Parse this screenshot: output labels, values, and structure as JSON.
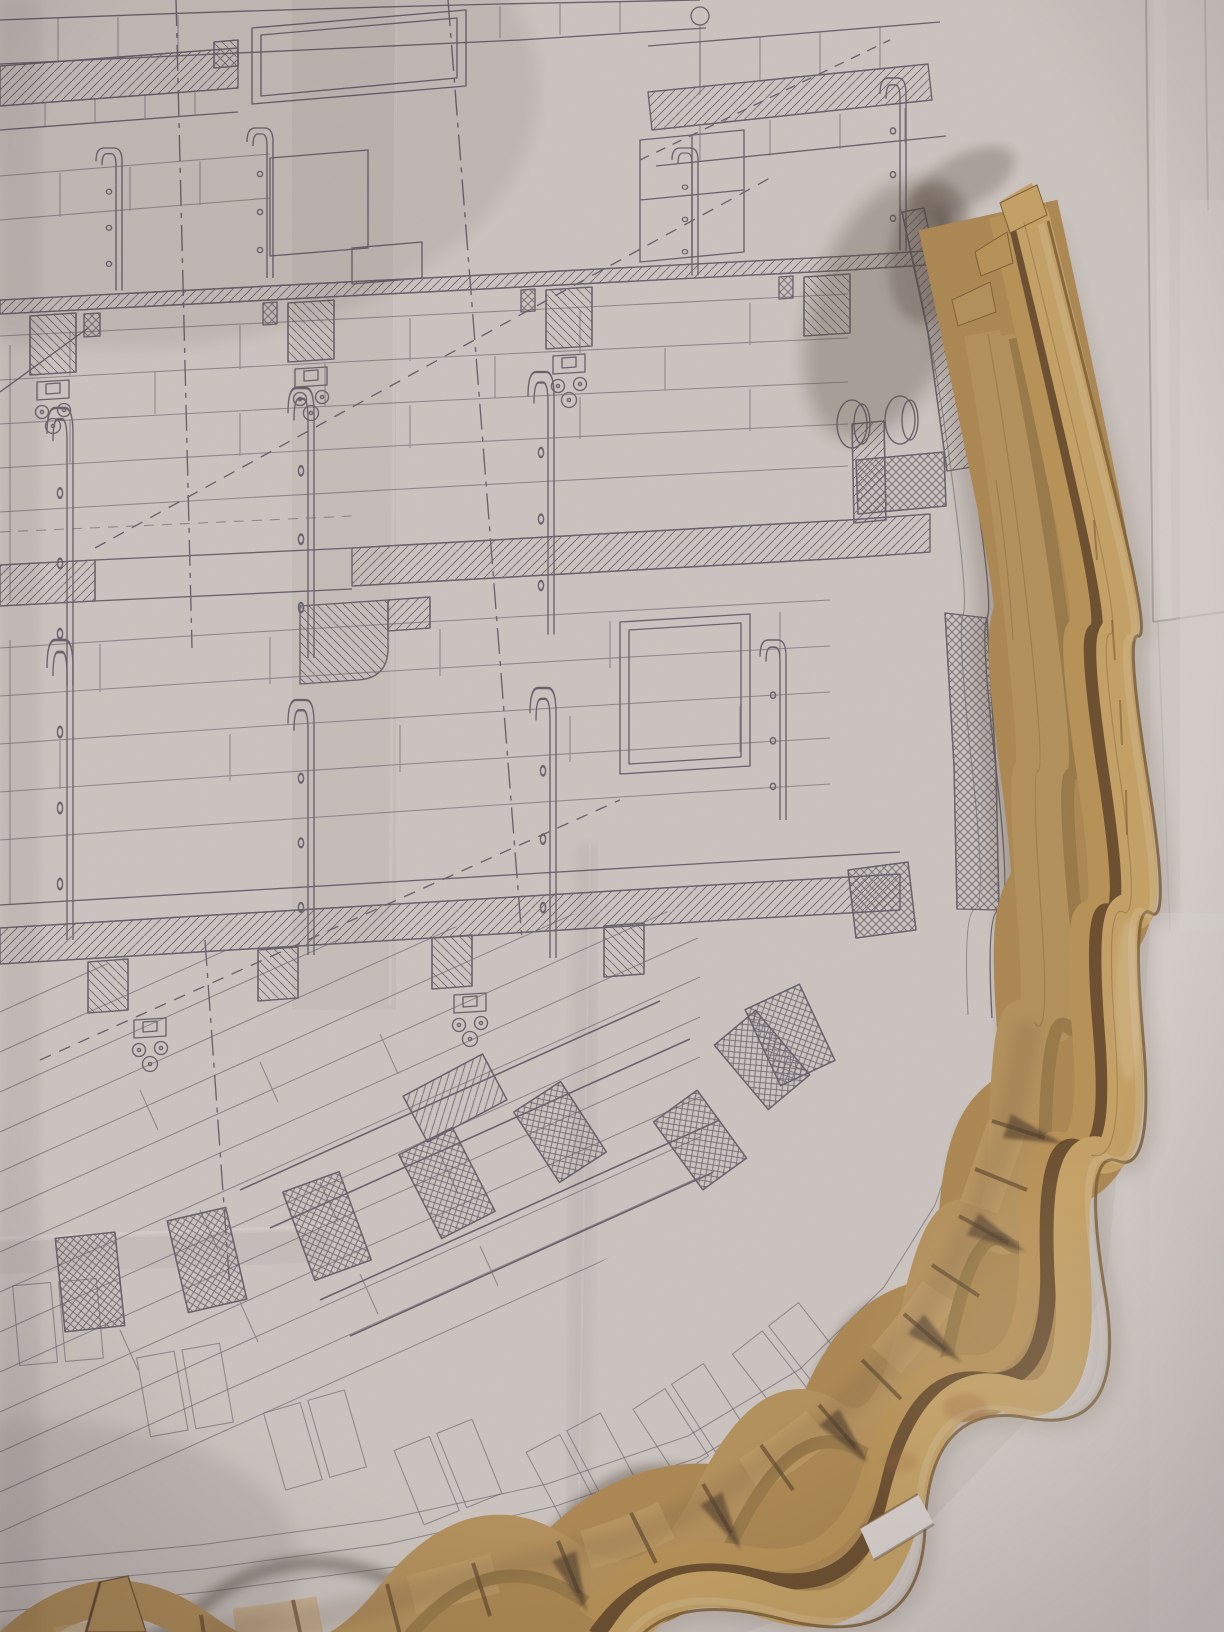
{
  "meta": {
    "type": "photograph",
    "subject": "Wooden ship model wale strips and frame heads laid over a matching midship cross-section plan drawing",
    "visible_text": "none"
  },
  "objects": {
    "plan_sheet": {
      "label": "folded ship plan sheet",
      "drawing": "structural midship cross-section: planked decks, hatched beams and clamps, stanchion straps, hanging-knee trefoil fittings, gunport, diagonal hold planking, crosshatched frames and wales, dashed reference lines"
    },
    "wale_strip_assembly": {
      "label": "laminated bent wood strips following the hull curve"
    },
    "model_frame_band": {
      "label": "row of wooden frame heads with shadow gaps along the bilge"
    },
    "creases": {
      "label": "paper fold creases"
    },
    "shadows": {
      "label": "warm cast shadows from the wood onto the paper"
    }
  },
  "colors": {
    "paper": "#d3ccc8",
    "paper_bright": "#dcd6d2",
    "ink": "#57525f",
    "wood_base": "#ad8950",
    "wood_a": "#b6925a",
    "wood_a_light": "#c6a269",
    "wood_rib": "#997a46",
    "wood_b": "#ba9355",
    "groove": "#6a4d2b",
    "wood_c": "#c7a363",
    "wood_edge": "#7a5c33",
    "shadow_warm": "#57483b",
    "shadow_deep": "#463527"
  }
}
